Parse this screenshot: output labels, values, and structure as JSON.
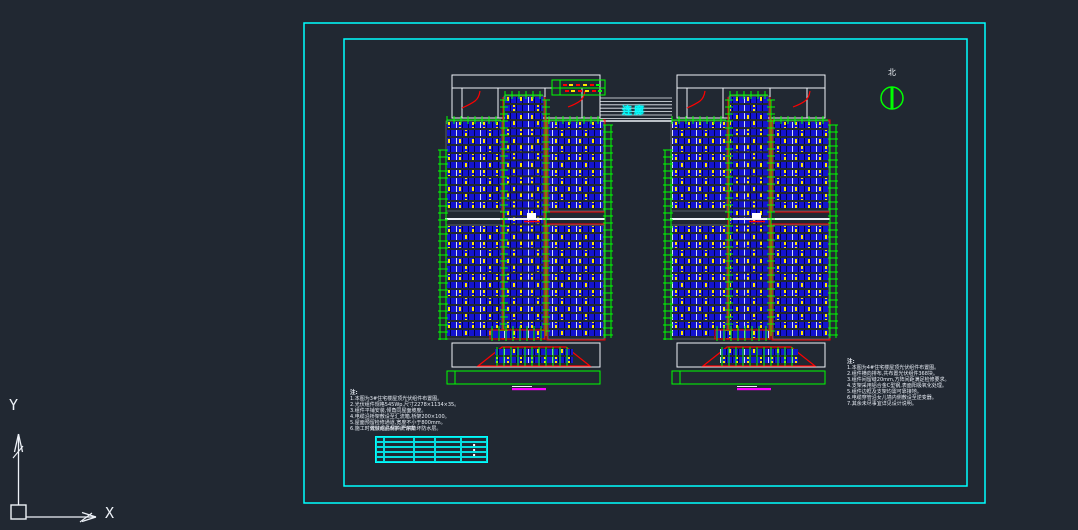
{
  "canvas": {
    "width": 1078,
    "height": 530
  },
  "colors": {
    "background": "#212832",
    "frame_cyan": "#00ffff",
    "green": "#00ff00",
    "red": "#ff0000",
    "panel_blue": "#1414cf",
    "panel_divider": "#00004d",
    "panel_module_edge": "#d7e0f2",
    "yellow": "#ffe800",
    "white": "#eef2f8",
    "magenta": "#ff00ff"
  },
  "labels": {
    "corridor": "连廊",
    "north": "北",
    "axis_x": "X",
    "axis_y": "Y"
  },
  "notes_left": {
    "title": "注:",
    "lines": [
      "1.本图为3#住宅楼屋顶光伏组件布置图。",
      "2.光伏组件规格545Wp,尺寸2278×1134×35。",
      "3.组件平铺安装,倾角同屋面坡度。",
      "4.电缆沿桥架敷设至汇流箱,桥架200×100。",
      "5.屋面预留检修通道,宽度不小于800mm。",
      "6.施工时做好成品保护,严禁破坏防水层。"
    ]
  },
  "notes_right": {
    "title": "注:",
    "lines": [
      "1.本图为4#住宅楼屋顶光伏组件布置图。",
      "2.组件横向排布,共布置光伏组件368块。",
      "3.组件间留缝20mm,方阵间距满足检修要求。",
      "4.支架采用铝合金C型钢,表面阳极氧化处理。",
      "5.组件边框及支架均需可靠接地。",
      "6.电缆穿管沿女儿墙内侧敷设至逆变器。",
      "7.其余未尽事宜详见设计说明。"
    ]
  },
  "table": {
    "title": "光伏组件材料统计表",
    "col_widths": [
      8,
      30,
      21,
      26,
      26
    ],
    "rows": 5,
    "cells": [
      [
        "",
        "",
        "",
        "",
        ""
      ],
      [
        "",
        "",
        "",
        "",
        "▪"
      ],
      [
        "",
        "",
        "",
        "",
        "▪"
      ],
      [
        "",
        "",
        "",
        "",
        "▪"
      ],
      [
        "",
        "",
        "",
        "",
        ""
      ]
    ]
  }
}
